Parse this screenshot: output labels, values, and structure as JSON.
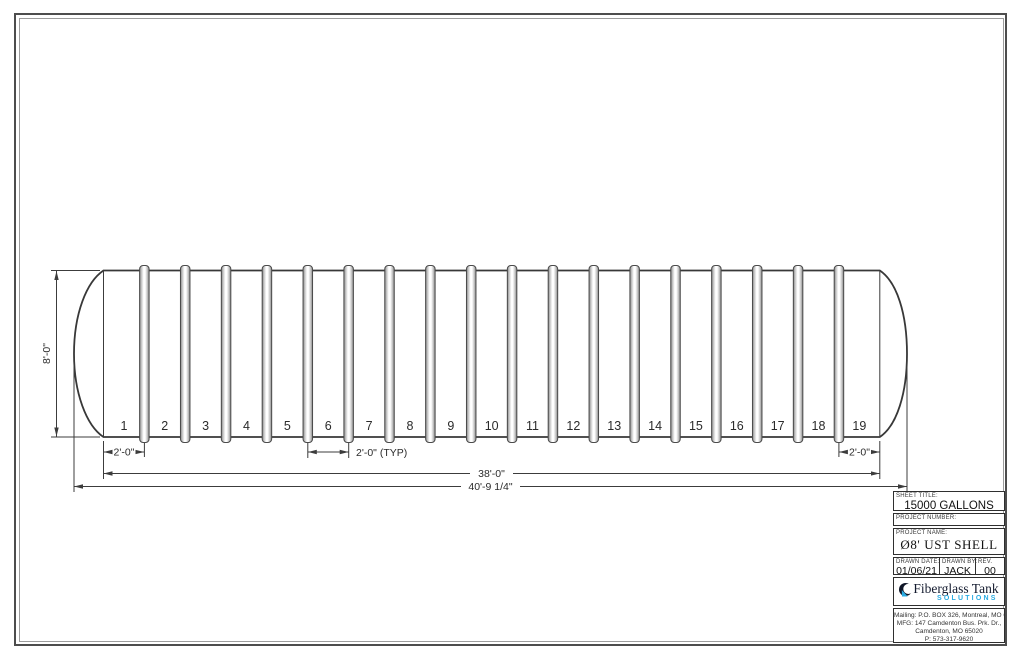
{
  "drawing": {
    "bay_labels": [
      "1",
      "2",
      "3",
      "4",
      "5",
      "6",
      "7",
      "8",
      "9",
      "10",
      "11",
      "12",
      "13",
      "14",
      "15",
      "16",
      "17",
      "18",
      "19"
    ],
    "dimensions": {
      "height": "8'-0\"",
      "end_bay_left": "2'-0\"",
      "typical_bay": "2'-0\" (TYP)",
      "end_bay_right": "2'-0\"",
      "straight_shell_length": "38'-0\"",
      "overall_length": "40'-9 1/4\""
    }
  },
  "title_block": {
    "sheet_title_label": "SHEET TITLE:",
    "sheet_title": "15000 GALLONS",
    "project_number_label": "PROJECT NUMBER:",
    "project_name_label": "PROJECT NAME:",
    "project_name": "Ø8' UST SHELL",
    "drawn_date_label": "DRAWN DATE:",
    "drawn_date": "01/06/21",
    "drawn_by_label": "DRAWN BY:",
    "drawn_by": "JACK",
    "rev_label": "REV.",
    "rev": "00",
    "logo": {
      "name": "Fiberglass Tank",
      "tagline": "SOLUTIONS",
      "accent_color": "#29abe2",
      "text_color": "#131a2e"
    },
    "address_lines": [
      "Mailing: P.O. BOX 326, Montreal, MO 65591",
      "MFG: 147 Camdenton Bus. Prk. Dr.,",
      "Camdenton, MO 65020",
      "P: 573-317-9620"
    ]
  }
}
